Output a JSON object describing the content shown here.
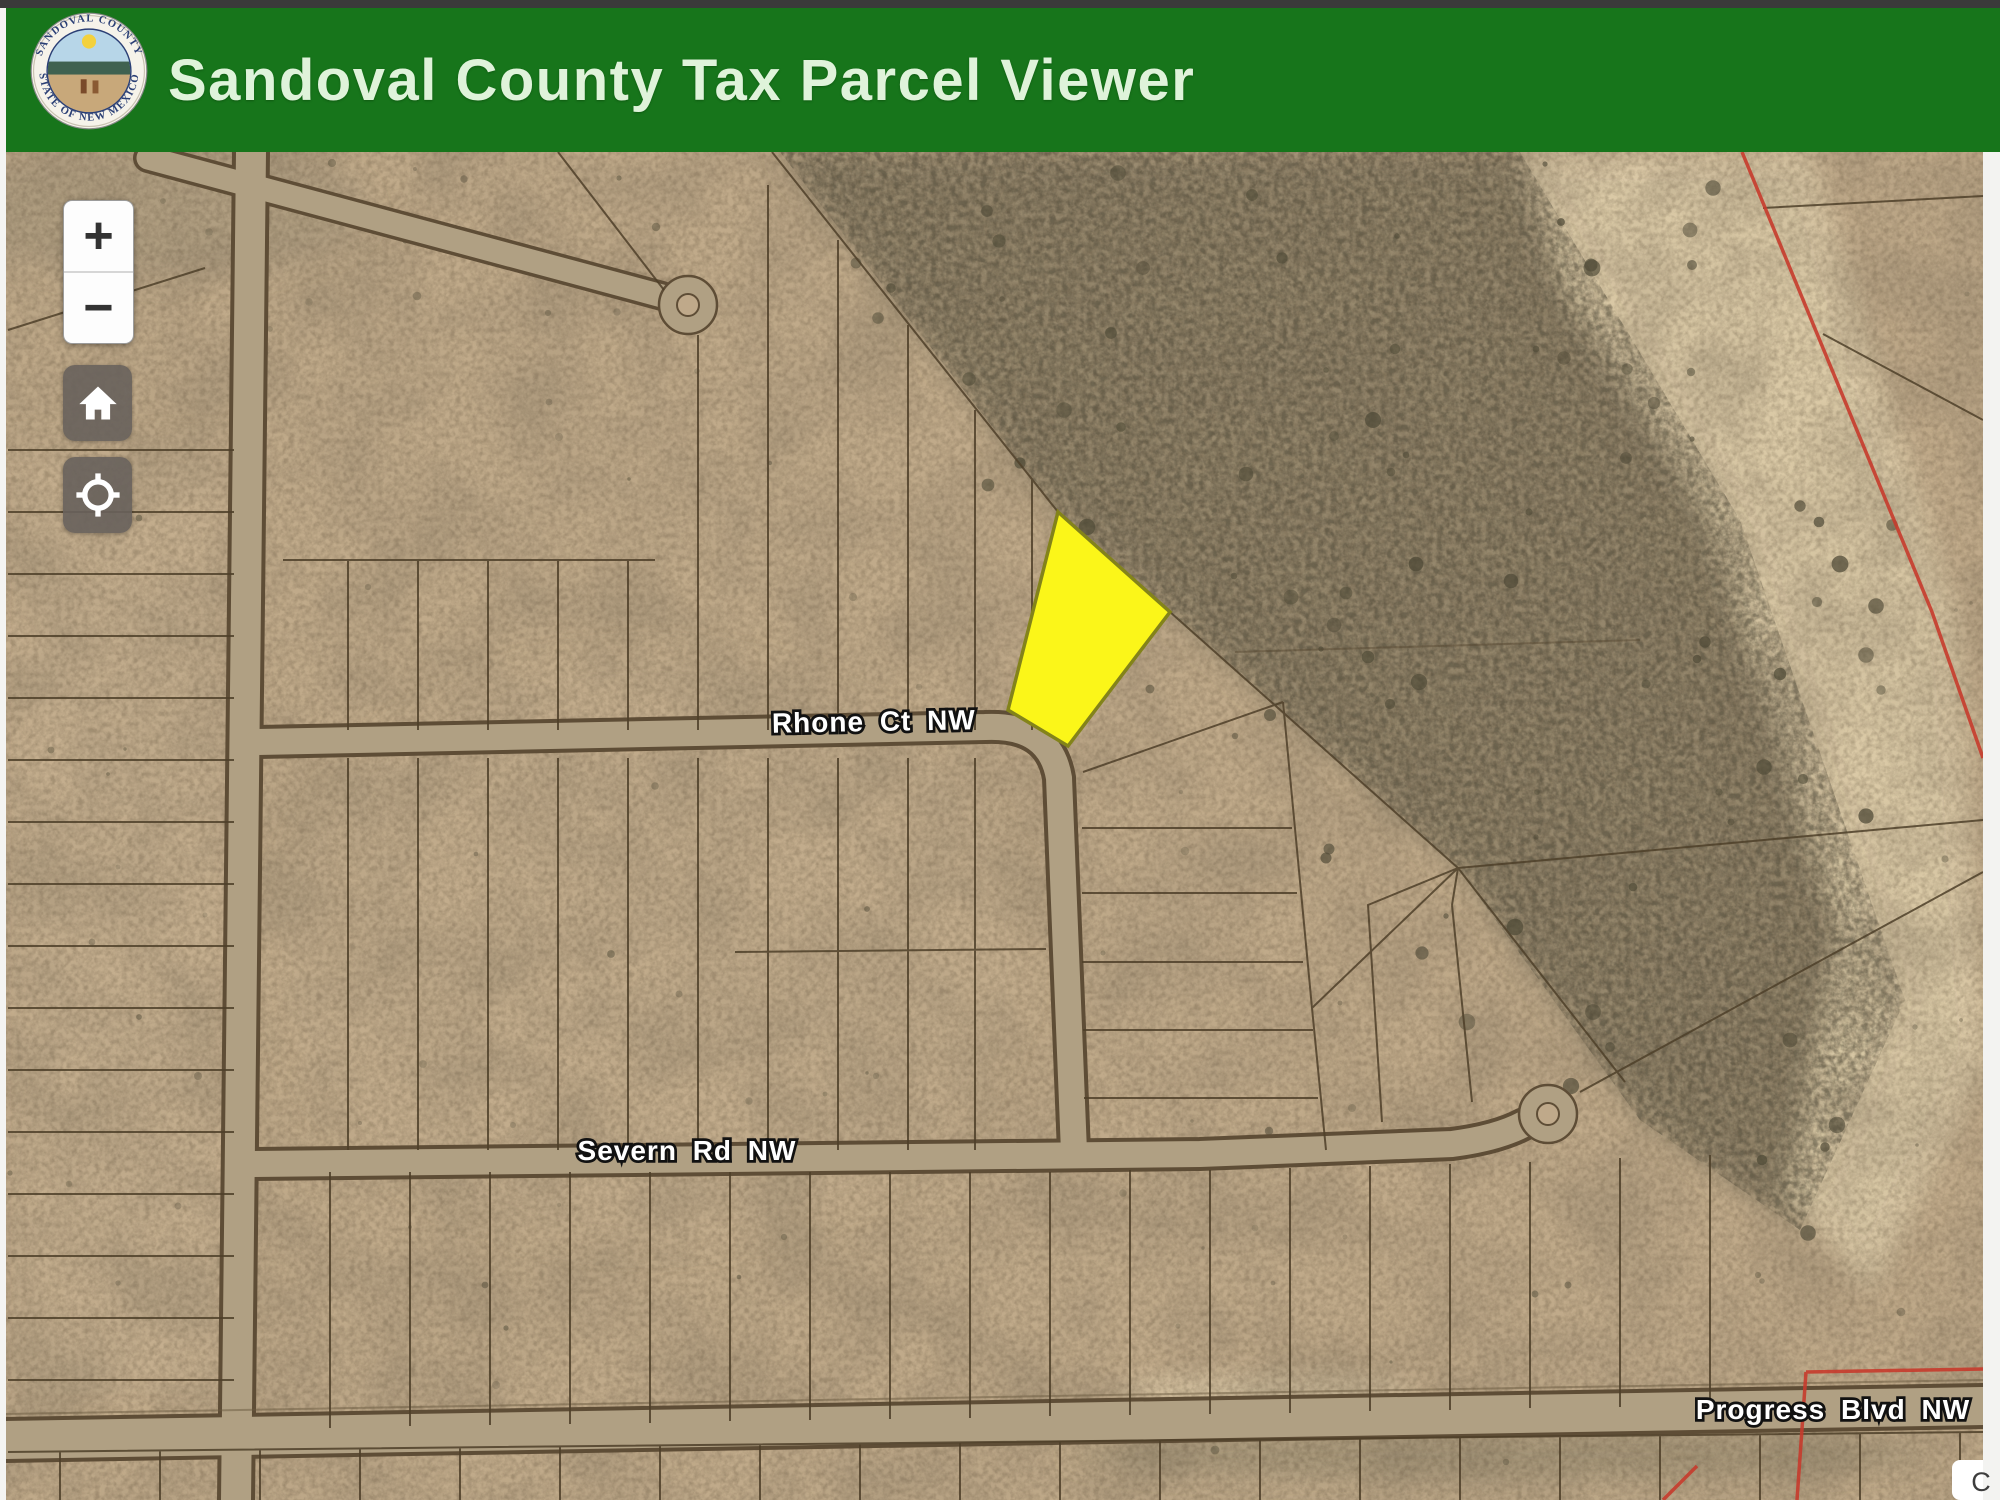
{
  "header": {
    "title": "Sandoval County Tax Parcel Viewer",
    "bg_color": "#17751b",
    "title_color": "#dff3da",
    "logo": {
      "icon": "county-seal",
      "ring_top_text": "SANDOVAL COUNTY",
      "ring_bottom_text": "STATE OF NEW MEXICO"
    }
  },
  "controls": {
    "zoom_in_label": "+",
    "zoom_out_label": "−",
    "icons": [
      "plus-icon",
      "minus-icon",
      "home-icon",
      "locate-icon"
    ]
  },
  "map": {
    "street_labels": {
      "rhone": "Rhone Ct NW",
      "severn": "Severn Rd NW",
      "progress": "Progress Blvd NW"
    },
    "attribution": "C",
    "colors": {
      "terrain_base": "#c0aa8a",
      "terrain_dark_zone": "#95886d",
      "sandy_wash": "#dbcaa8",
      "parcel_line": "#4e3f29",
      "road_fill": "#b0a083",
      "road_edge": "#5e4d36",
      "highlight_fill": "#fbf619",
      "highlight_stroke": "#83831a",
      "boundary_red": "#c63b2c"
    }
  }
}
